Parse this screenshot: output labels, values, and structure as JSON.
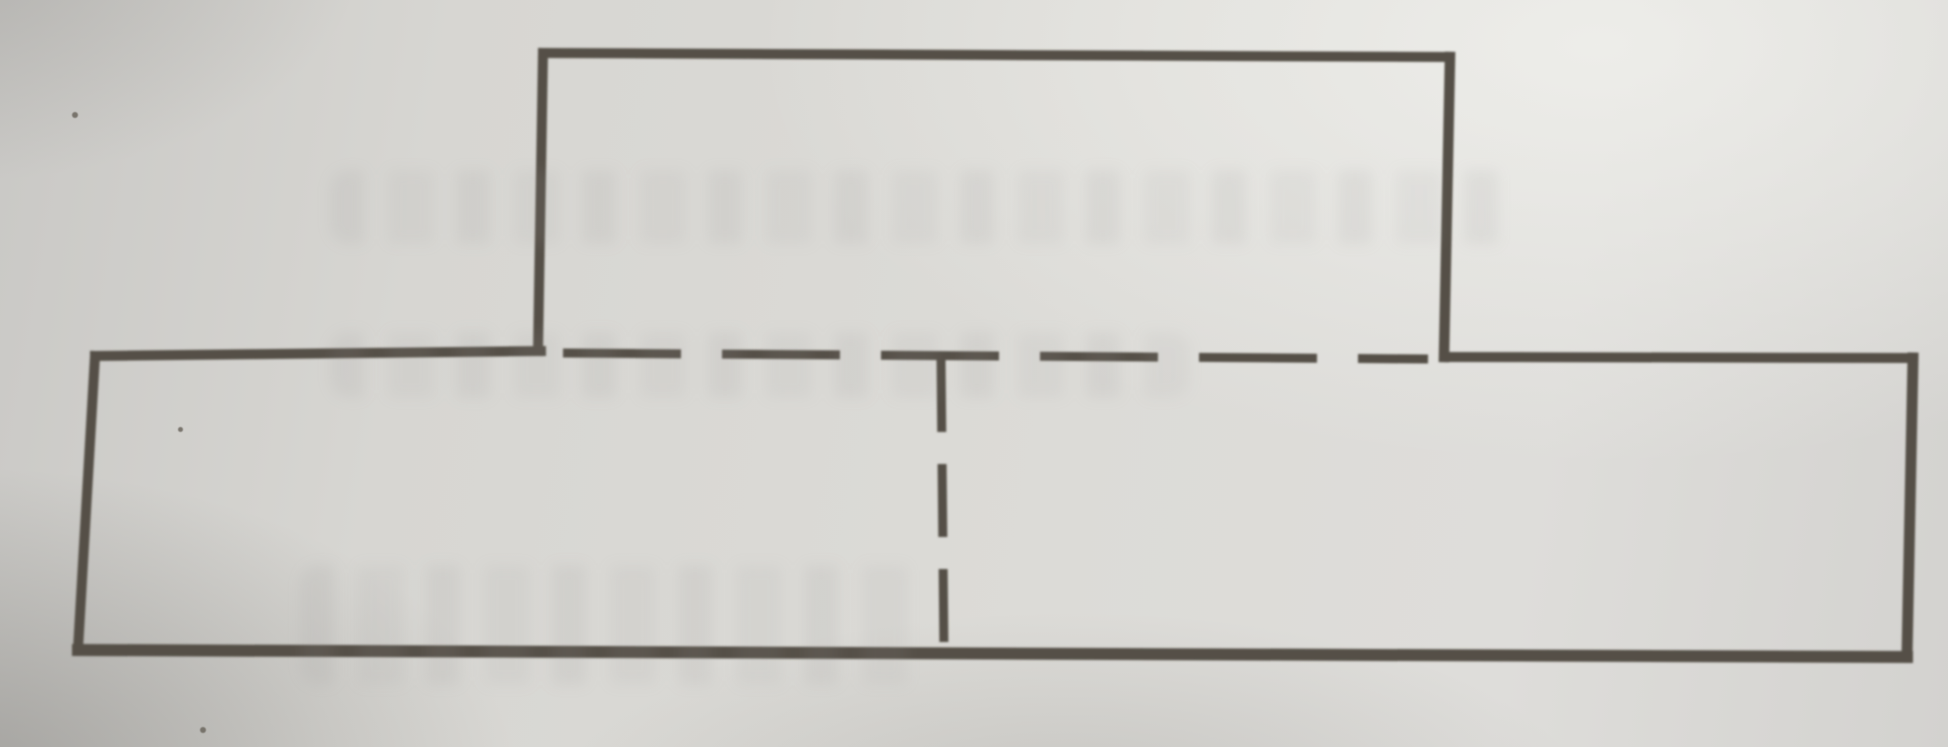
{
  "figure": {
    "kind": "geometry-textbook-photo",
    "description": "Composite figure: wide lower rectangle with a smaller rectangle centered on top; the shared edge and the vertical midline of the lower rectangle are drawn dashed",
    "canvas": {
      "width": 1948,
      "height": 747
    },
    "line_color": "#555046",
    "lines": [
      {
        "name": "top-rect-top-edge",
        "x1": 543,
        "y1": 53,
        "x2": 1450,
        "y2": 57,
        "w": 10,
        "dash": null
      },
      {
        "name": "top-rect-left-edge",
        "x1": 543,
        "y1": 53,
        "x2": 538,
        "y2": 351,
        "w": 10,
        "dash": null
      },
      {
        "name": "top-rect-right-edge",
        "x1": 1450,
        "y1": 57,
        "x2": 1444,
        "y2": 357,
        "w": 10.5,
        "dash": null
      },
      {
        "name": "bottom-rect-top-edge-left",
        "x1": 95,
        "y1": 356,
        "x2": 541,
        "y2": 351,
        "w": 10,
        "dash": null
      },
      {
        "name": "shared-edge-dashed-line",
        "x1": 563,
        "y1": 353,
        "x2": 1428,
        "y2": 359,
        "w": 9,
        "dash": "118 41"
      },
      {
        "name": "bottom-rect-top-edge-right",
        "x1": 1444,
        "y1": 357,
        "x2": 1913,
        "y2": 358,
        "w": 10,
        "dash": null
      },
      {
        "name": "bottom-rect-left-edge",
        "x1": 95,
        "y1": 356,
        "x2": 78,
        "y2": 649,
        "w": 10,
        "dash": null
      },
      {
        "name": "bottom-rect-right-edge",
        "x1": 1913,
        "y1": 358,
        "x2": 1907,
        "y2": 656,
        "w": 11,
        "dash": null
      },
      {
        "name": "bottom-rect-bottom-edge",
        "x1": 78,
        "y1": 650,
        "x2": 1907,
        "y2": 657,
        "w": 12,
        "dash": null
      },
      {
        "name": "vertical-midline-dashed-line",
        "x1": 941,
        "y1": 359,
        "x2": 944,
        "y2": 653,
        "w": 9,
        "dash": "73 32"
      }
    ],
    "paper_artifacts": {
      "specks": [
        {
          "x": 75,
          "y": 115,
          "r": 3
        },
        {
          "x": 180,
          "y": 429,
          "r": 2.5
        },
        {
          "x": 203,
          "y": 730,
          "r": 3
        }
      ],
      "ink_bleedthrough_bands": [
        {
          "x": 330,
          "y": 170,
          "w": 1190,
          "h": 74
        },
        {
          "x": 330,
          "y": 332,
          "w": 860,
          "h": 66
        },
        {
          "x": 300,
          "y": 565,
          "w": 620,
          "h": 120
        }
      ]
    }
  }
}
